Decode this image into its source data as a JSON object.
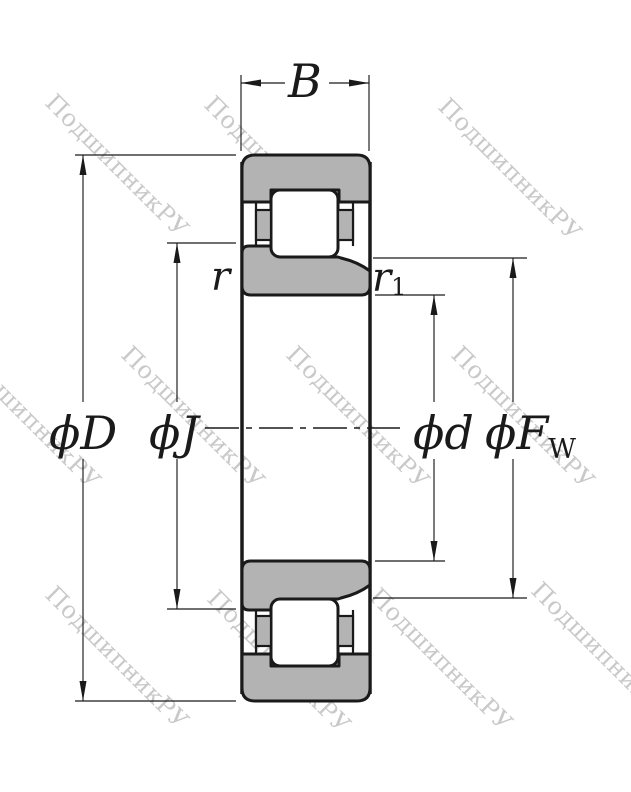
{
  "watermark": {
    "text": "ПодшипникРУ"
  },
  "colors": {
    "line": "#1a1a1a",
    "ring_fill": "#b3b3b3",
    "background": "#ffffff",
    "watermark": "#c9c9c9"
  },
  "dimensions": {
    "width_label": "B",
    "outer_diameter": "ϕD",
    "flange_diameter": "ϕJ",
    "bore_diameter": "ϕd",
    "raceway_diameter_base": "ϕF",
    "raceway_diameter_sub": "W",
    "chamfer_outer": "r",
    "chamfer_inner_base": "r",
    "chamfer_inner_sub": "1"
  }
}
